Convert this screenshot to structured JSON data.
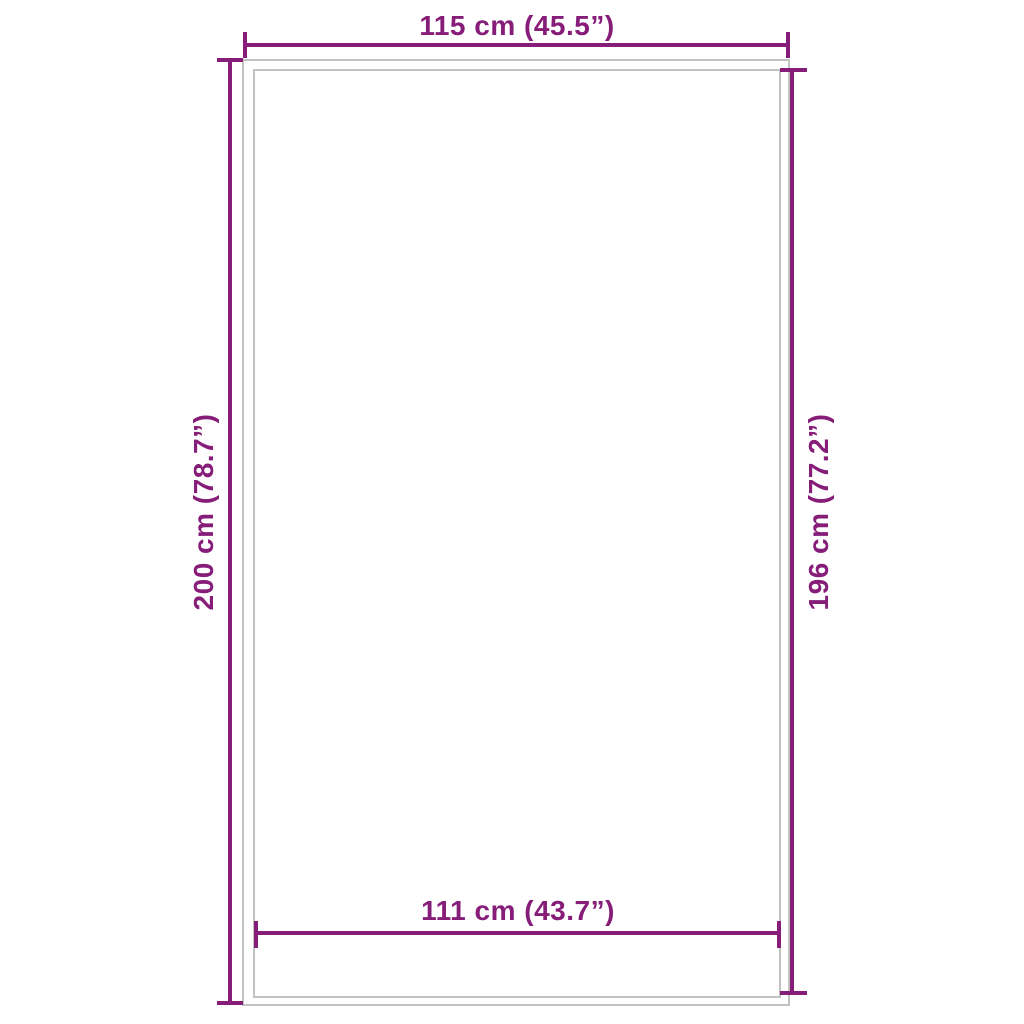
{
  "diagram": {
    "type": "product-dimension-diagram",
    "labels": {
      "top_width": "115 cm (45.5”)",
      "bottom_width": "111 cm (43.7”)",
      "left_height": "200 cm (78.7”)",
      "right_height": "196 cm (77.2”)"
    },
    "colors": {
      "dimension": "#861d79",
      "outline": "#c2c2c2",
      "background": "#ffffff"
    }
  }
}
